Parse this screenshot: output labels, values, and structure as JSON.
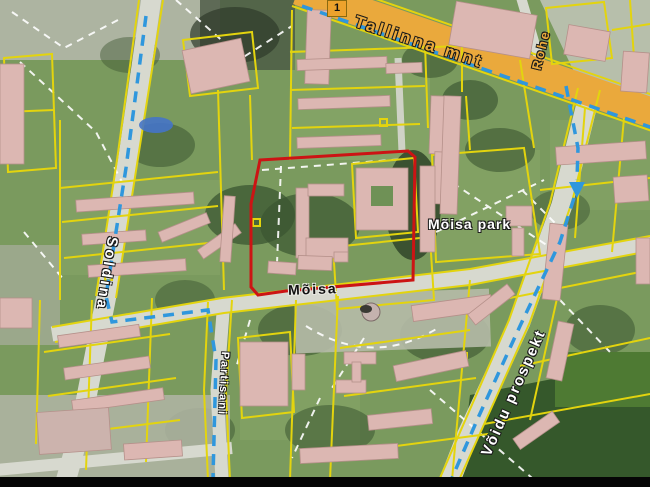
{
  "map": {
    "labels": {
      "main_road": "Tallinna mnt",
      "route_badge": "1",
      "street_rohe": "Rohe",
      "street_soldina": "Soldina",
      "street_moisa": "Mõisa",
      "park": "Mõisa park",
      "street_partisani": "Partisani",
      "street_voidu": "Võidu prospekt"
    },
    "colors": {
      "main_road": "#eaa93c",
      "parcel_line": "#e3d40e",
      "selection_outline": "#cc1414",
      "route_line": "#2f97dd",
      "building": "#dcb7b2",
      "road": "#d7d9cf",
      "vegetation": "#7a9a5e",
      "path_dash": "#ffffff",
      "field_dark": "#35582b",
      "pond": "#4574c8",
      "photo_bar": "#050505"
    }
  }
}
